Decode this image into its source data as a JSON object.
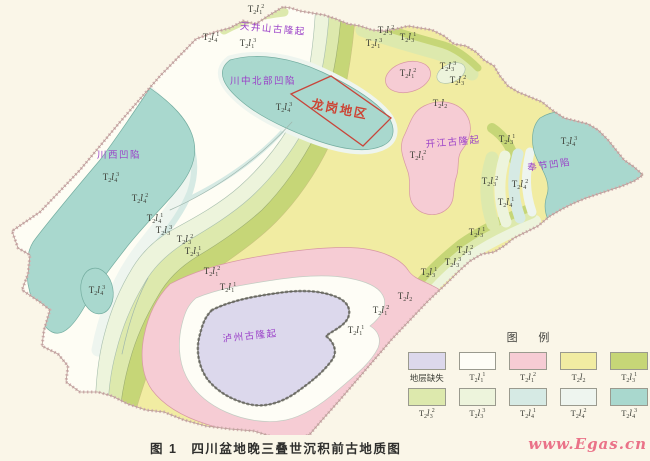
{
  "caption": "图 1　四川盆地晚三叠世沉积前古地质图",
  "watermark": "www.Egas.cn",
  "colors": {
    "page_bg": "#faf6e8",
    "basin_fill": "#fefdf4",
    "border": "#c49a9c",
    "contour": "#9fb6ac",
    "missing": "#dcd8ec",
    "t2l1_1": "#fefdf6",
    "t2l1_2": "#f6ccd4",
    "t2l2": "#f1eca2",
    "t2l3_1": "#c6d677",
    "t2l3_2": "#dde9ad",
    "t2l3_3": "#edf4dc",
    "t2l4_1": "#d6eae4",
    "t2l4_2": "#eef5ef",
    "t2l4_3": "#a9d8ce",
    "structure_label": "#9a3fc8",
    "area_label": "#cc4434",
    "strat_label": "#3c3e36",
    "caption": "#2f2f2d",
    "watermark": "#ea7288",
    "longgang_box": "#c8453a",
    "tick_border": "#63635a"
  },
  "legend": {
    "title": "图 例",
    "items": [
      {
        "label": "地层缺失",
        "color_key": "missing"
      },
      {
        "label": "T2l1^1",
        "color_key": "t2l1_1"
      },
      {
        "label": "T2l1^2",
        "color_key": "t2l1_2"
      },
      {
        "label": "T2l2",
        "color_key": "t2l2"
      },
      {
        "label": "T2l3^1",
        "color_key": "t2l3_1"
      },
      {
        "label": "T2l3^2",
        "color_key": "t2l3_2"
      },
      {
        "label": "T2l3^3",
        "color_key": "t2l3_3"
      },
      {
        "label": "T2l4^1",
        "color_key": "t2l4_1"
      },
      {
        "label": "T2l4^2",
        "color_key": "t2l4_2"
      },
      {
        "label": "T2l4^3",
        "color_key": "t2l4_3"
      }
    ]
  },
  "map": {
    "structure_labels": [
      {
        "t": "天井山古隆起",
        "x": 273,
        "y": 28,
        "r": 5
      },
      {
        "t": "川中北部凹陷",
        "x": 263,
        "y": 80,
        "r": 0
      },
      {
        "t": "川西凹陷",
        "x": 119,
        "y": 154,
        "r": 0
      },
      {
        "t": "开江古隆起",
        "x": 453,
        "y": 141,
        "r": -5
      },
      {
        "t": "奉节凹陷",
        "x": 549,
        "y": 164,
        "r": -8
      },
      {
        "t": "泸州古隆起",
        "x": 250,
        "y": 335,
        "r": -6
      }
    ],
    "area_label": {
      "t": "龙岗地区",
      "x": 340,
      "y": 108,
      "r": 11
    },
    "strat_labels": [
      {
        "c": "T2l1^2",
        "x": 256,
        "y": 10
      },
      {
        "c": "T2l4^1",
        "x": 211,
        "y": 38
      },
      {
        "c": "T2l1^3",
        "x": 248,
        "y": 44
      },
      {
        "c": "T2l4^3",
        "x": 284,
        "y": 108
      },
      {
        "c": "T2l4^3",
        "x": 111,
        "y": 178
      },
      {
        "c": "T2l4^2",
        "x": 140,
        "y": 199
      },
      {
        "c": "T2l4^1",
        "x": 155,
        "y": 219
      },
      {
        "c": "T2l3^3",
        "x": 164,
        "y": 231
      },
      {
        "c": "T2l3^2",
        "x": 185,
        "y": 240
      },
      {
        "c": "T2l3^1",
        "x": 193,
        "y": 252
      },
      {
        "c": "T2l1^2",
        "x": 212,
        "y": 272
      },
      {
        "c": "T2l1^1",
        "x": 228,
        "y": 288
      },
      {
        "c": "T2l4^3",
        "x": 97,
        "y": 291
      },
      {
        "c": "T2l3^2",
        "x": 386,
        "y": 31
      },
      {
        "c": "T2l3^1",
        "x": 408,
        "y": 38
      },
      {
        "c": "T2l1^3",
        "x": 374,
        "y": 44
      },
      {
        "c": "T2l1^2",
        "x": 408,
        "y": 74
      },
      {
        "c": "T2l3^3",
        "x": 448,
        "y": 67
      },
      {
        "c": "T2l3^2",
        "x": 458,
        "y": 81
      },
      {
        "c": "T2l2",
        "x": 440,
        "y": 104
      },
      {
        "c": "T2l1^2",
        "x": 418,
        "y": 156
      },
      {
        "c": "T2l3^1",
        "x": 507,
        "y": 140
      },
      {
        "c": "T2l4^3",
        "x": 569,
        "y": 142
      },
      {
        "c": "T2l3^2",
        "x": 490,
        "y": 182
      },
      {
        "c": "T2l4^2",
        "x": 520,
        "y": 185
      },
      {
        "c": "T2l4^1",
        "x": 506,
        "y": 203
      },
      {
        "c": "T2l3^1",
        "x": 477,
        "y": 233
      },
      {
        "c": "T2l3^2",
        "x": 465,
        "y": 251
      },
      {
        "c": "T2l3^3",
        "x": 453,
        "y": 263
      },
      {
        "c": "T2l3^1",
        "x": 429,
        "y": 273
      },
      {
        "c": "T2l2",
        "x": 405,
        "y": 297
      },
      {
        "c": "T2l1^2",
        "x": 381,
        "y": 311
      },
      {
        "c": "T2l1^1",
        "x": 356,
        "y": 331
      }
    ]
  }
}
